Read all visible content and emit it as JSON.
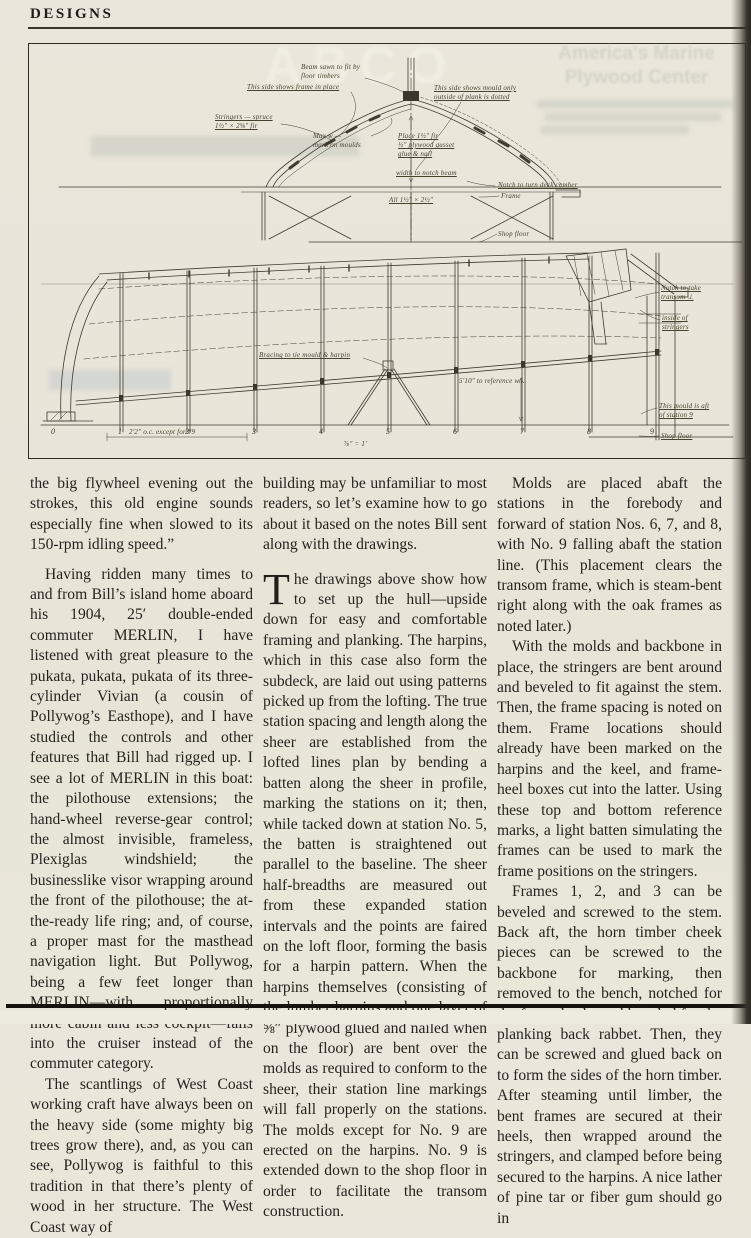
{
  "page": {
    "header_title": "DESIGNS"
  },
  "ghost": {
    "abco": "ABCO",
    "ad_title": "America's Marine\nPlywood Center"
  },
  "drawing": {
    "annotations": [
      {
        "id": "beam-note",
        "text": "Beam sawn to fit by\nfloor timbers"
      },
      {
        "id": "frame-side",
        "text": "This side shows frame in place"
      },
      {
        "id": "mould-side",
        "text": "This side shows mould only\noutside of plank is dotted"
      },
      {
        "id": "stringers",
        "text": "Stringers — spruce\n1½″ × 2⅝″ fir"
      },
      {
        "id": "max-width",
        "text": "Max w —\nmark on moulds"
      },
      {
        "id": "gusset",
        "text": "Place 1½″ fir\n½″ plywood gusset\nglue & nail"
      },
      {
        "id": "notch-beam",
        "text": "width to notch beam"
      },
      {
        "id": "deck-camber",
        "text": "Notch to turn deck camber"
      },
      {
        "id": "frame",
        "text": "Frame"
      },
      {
        "id": "all-dim",
        "text": "All 1½″ × 2½″"
      },
      {
        "id": "shop-floor-upper",
        "text": "Shop floor"
      },
      {
        "id": "bracing",
        "text": "Bracing to tie mould & harpin"
      },
      {
        "id": "reference",
        "text": "5′10″ to reference w.l."
      },
      {
        "id": "notch-transom",
        "text": "Notch to take\ntransom ⊥"
      },
      {
        "id": "inside-stringers",
        "text": "inside of\nstringers"
      },
      {
        "id": "mould-aft",
        "text": "This mould is aft\nof station 9"
      },
      {
        "id": "shop-floor-lower",
        "text": "Shop floor"
      },
      {
        "id": "spacing",
        "text": "2′2″ o.c. except for #9"
      },
      {
        "id": "scale",
        "text": "⅞″ = 1′"
      }
    ],
    "stations": [
      "0",
      "1",
      "2",
      "3",
      "4",
      "5",
      "6",
      "7",
      "8",
      "9"
    ]
  },
  "article": {
    "columns": [
      {
        "paragraphs": [
          "the big flywheel evening out the strokes, this old engine sounds especially fine when slowed to its 150-rpm idling speed.”",
          "Having ridden many times to and from Bill’s island home aboard his 1904, 25′ double-ended commuter MERLIN, I have listened with great pleasure to the pukata, pukata, pukata of its three-cylinder Vivian (a cousin of Pollywog’s Easthope), and I have studied the controls and other features that Bill had rigged up. I see a lot of MERLIN in this boat: the pilothouse extensions; the hand-wheel reverse-gear control; the almost invisible, frameless, Plexiglas windshield; the businesslike visor wrapping around the front of the pilothouse; the at-the-ready life ring; and, of course, a proper mast for the masthead navigation light. But Pollywog, being a few feet longer than MERLIN—with proportionally more cabin and less cockpit—falls into the cruiser instead of the commuter category.",
          "The scantlings of West Coast working craft have always been on the heavy side (some mighty big trees grow there), and, as you can see, Pollywog is faithful to this tradition in that there’s plenty of wood in her structure. The West Coast way of"
        ]
      },
      {
        "paragraphs": [
          "building may be unfamiliar to most readers, so let’s examine how to go about it based on the notes Bill sent along with the drawings."
        ],
        "dropcap": "T",
        "dropcap_paragraph": "he drawings above show how to set up the hull—upside down for easy and comfortable framing and planking. The harpins, which in this case also form the subdeck, are laid out using patterns picked up from the lofting. The true station spacing and length along the sheer are established from the lofted lines plan by bending a batten along the sheer in profile, marking the stations on it; then, while tacked down at station No. 5, the batten is straightened out parallel to the baseline. The sheer half-breadths are measured out from these expanded station intervals and the points are faired on the loft floor, forming the basis for a harpin pattern. When the harpins themselves (consisting of the lumber harpins and one layer of ⅝″ plywood glued and nailed when on the floor) are bent over the molds as required to conform to the sheer, their station line markings will fall properly on the stations. The molds except for No. 9 are erected on the harpins. No. 9 is extended down to the shop floor in order to facilitate the transom construction."
      },
      {
        "paragraphs": [
          "Molds are placed abaft the stations in the forebody and forward of station Nos. 6, 7, and 8, with No. 9 falling abaft the station line. (This placement clears the transom frame, which is steam-bent right along with the oak frames as noted later.)",
          "With the molds and backbone in place, the stringers are bent around and beveled to fit against the stem. Then, the frame spacing is noted on them. Frame locations should already have been marked on the harpins and the keel, and frame-heel boxes cut into the latter. Using these top and bottom reference marks, a light batten simulating the frames can be used to mark the frame positions on the stringers.",
          "Frames 1, 2, and 3 can be beveled and screwed to the stem. Back aft, the horn timber cheek pieces can be screwed to the backbone for marking, then removed to the bench, notched for the frame heels, and beveled for the planking back rabbet. Then, they can be screwed and glued back on to form the sides of the horn timber. After steaming until limber, the bent frames are secured at their heels, then wrapped around the stringers, and clamped before being secured to the harpins. A nice lather of pine tar or fiber gum should go in"
        ]
      }
    ]
  }
}
